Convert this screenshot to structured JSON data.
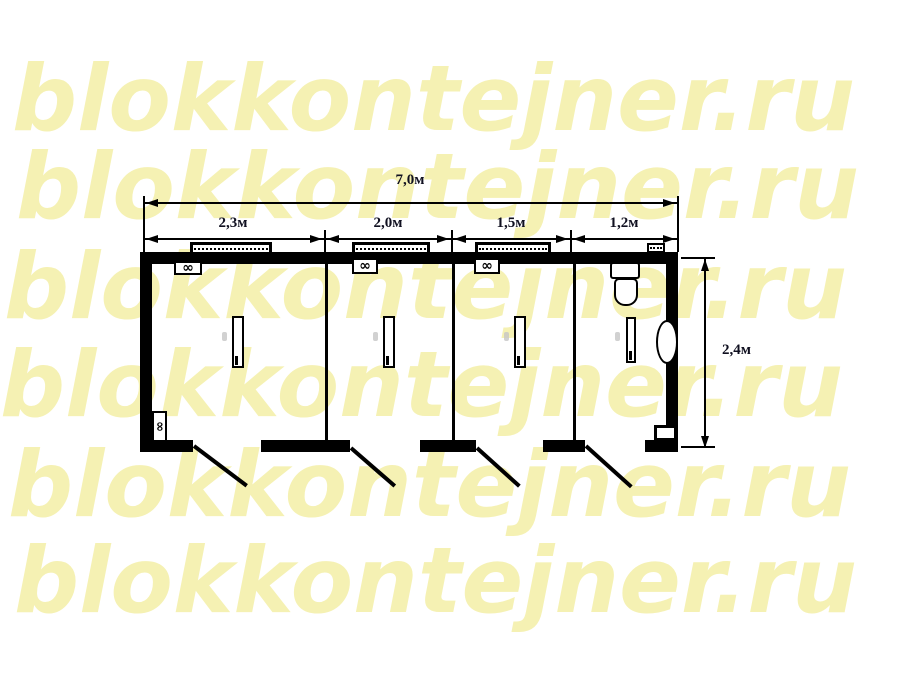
{
  "watermark": {
    "text": "blokkontejner.ru",
    "color": "#f5f1b3",
    "rows": 6
  },
  "plan": {
    "dimensions": {
      "total_width": "7,0м",
      "sections": [
        "2,3м",
        "2,0м",
        "1,5м",
        "1,2м"
      ],
      "height": "2,4м"
    },
    "symbols": {
      "heater_glyph": "∞"
    },
    "colors": {
      "line": "#000000",
      "background": "#ffffff",
      "watermark": "#f5f1b3"
    }
  }
}
